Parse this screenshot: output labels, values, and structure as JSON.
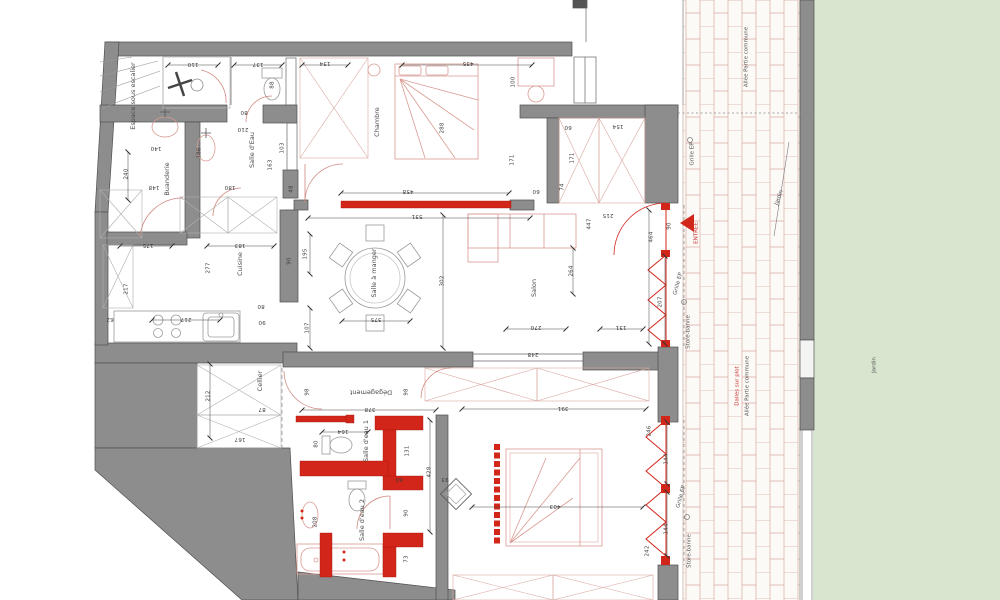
{
  "title": "Plan d'appartement",
  "colors": {
    "wall": "#8d8d8d",
    "wall_edge": "#4f4f4f",
    "new_wall_red": "#d3261a",
    "furniture_line": "#d99a92",
    "garden_green": "#d8e6cf",
    "paving_joint": "#dcaaa2",
    "dim_text": "#3b3b3b",
    "red_text": "#cc3230"
  },
  "rooms": [
    {
      "t": "Espace sous escalier",
      "x": 133,
      "y": 96,
      "r": -90
    },
    {
      "t": "Salle d'Eau",
      "x": 252,
      "y": 150,
      "r": -90
    },
    {
      "t": "Buanderie",
      "x": 167,
      "y": 179,
      "r": -90
    },
    {
      "t": "Chambre",
      "x": 377,
      "y": 122,
      "r": -90
    },
    {
      "t": "Cuisine",
      "x": 240,
      "y": 264,
      "r": -90
    },
    {
      "t": "Salle à manger",
      "x": 374,
      "y": 273,
      "r": -90
    },
    {
      "t": "Salon",
      "x": 534,
      "y": 288,
      "r": -90
    },
    {
      "t": "Cellier",
      "x": 260,
      "y": 381,
      "r": -90
    },
    {
      "t": "Dégagement",
      "x": 371,
      "y": 392,
      "r": 180
    },
    {
      "t": "Salle d'eau 1",
      "x": 366,
      "y": 441,
      "r": -90
    },
    {
      "t": "Salle d'eau 2",
      "x": 362,
      "y": 520,
      "r": -90
    }
  ],
  "annotations": [
    {
      "t": "ENTREE",
      "x": 697,
      "y": 233,
      "r": -90,
      "c": "red_text"
    },
    {
      "t": "Store-banne",
      "x": 689,
      "y": 332,
      "r": -90
    },
    {
      "t": "Store-banne",
      "x": 690,
      "y": 551,
      "r": -90
    },
    {
      "t": "Grille EP",
      "x": 693,
      "y": 154,
      "r": -90
    },
    {
      "t": "Grille EP",
      "x": 679,
      "y": 284,
      "r": -75
    },
    {
      "t": "Grille EP",
      "x": 682,
      "y": 497,
      "r": -75
    },
    {
      "t": "Allée Partie commune",
      "x": 747,
      "y": 57,
      "r": -90
    },
    {
      "t": "Allée Partie commune",
      "x": 748,
      "y": 386,
      "r": -90
    },
    {
      "t": "Dalles sur plot",
      "x": 738,
      "y": 386,
      "r": -90,
      "c": "red_text"
    },
    {
      "t": "Jardin",
      "x": 875,
      "y": 365,
      "r": -90
    },
    {
      "t": "Jardin",
      "x": 780,
      "y": 198,
      "r": -70
    }
  ],
  "dimensions": [
    {
      "t": "110",
      "x": 193,
      "y": 63,
      "r": 180
    },
    {
      "t": "137",
      "x": 258,
      "y": 63,
      "r": 180
    },
    {
      "t": "134",
      "x": 325,
      "y": 62,
      "r": 180
    },
    {
      "t": "435",
      "x": 468,
      "y": 62,
      "r": 180
    },
    {
      "t": "100",
      "x": 514,
      "y": 82,
      "r": -90
    },
    {
      "t": "88",
      "x": 273,
      "y": 85,
      "r": -90
    },
    {
      "t": "80",
      "x": 244,
      "y": 111,
      "r": 180
    },
    {
      "t": "210",
      "x": 243,
      "y": 128,
      "r": 180
    },
    {
      "t": "140",
      "x": 156,
      "y": 147,
      "r": 180
    },
    {
      "t": "186",
      "x": 200,
      "y": 153,
      "r": -90
    },
    {
      "t": "103",
      "x": 283,
      "y": 148,
      "r": -90
    },
    {
      "t": "163",
      "x": 271,
      "y": 165,
      "r": -90
    },
    {
      "t": "240",
      "x": 127,
      "y": 174,
      "r": -90
    },
    {
      "t": "148",
      "x": 154,
      "y": 186,
      "r": 180
    },
    {
      "t": "180",
      "x": 230,
      "y": 186,
      "r": 180
    },
    {
      "t": "48",
      "x": 292,
      "y": 189,
      "r": -90
    },
    {
      "t": "288",
      "x": 443,
      "y": 128,
      "r": -90
    },
    {
      "t": "458",
      "x": 408,
      "y": 190,
      "r": 180
    },
    {
      "t": "531",
      "x": 417,
      "y": 215,
      "r": 180
    },
    {
      "t": "154",
      "x": 618,
      "y": 125,
      "r": 180
    },
    {
      "t": "60",
      "x": 568,
      "y": 126,
      "r": 180
    },
    {
      "t": "171",
      "x": 513,
      "y": 160,
      "r": -90
    },
    {
      "t": "171",
      "x": 573,
      "y": 158,
      "r": -90
    },
    {
      "t": "74",
      "x": 563,
      "y": 187,
      "r": -90
    },
    {
      "t": "60",
      "x": 536,
      "y": 190,
      "r": 180
    },
    {
      "t": "447",
      "x": 590,
      "y": 224,
      "r": -90
    },
    {
      "t": "215",
      "x": 608,
      "y": 214,
      "r": 180
    },
    {
      "t": "464",
      "x": 652,
      "y": 237,
      "r": -90
    },
    {
      "t": "90",
      "x": 670,
      "y": 226,
      "r": -90
    },
    {
      "t": "207",
      "x": 661,
      "y": 302,
      "r": -90
    },
    {
      "t": "131",
      "x": 621,
      "y": 326,
      "r": 180
    },
    {
      "t": "264",
      "x": 572,
      "y": 271,
      "r": -90
    },
    {
      "t": "270",
      "x": 536,
      "y": 326,
      "r": 180
    },
    {
      "t": "248",
      "x": 533,
      "y": 353,
      "r": 180
    },
    {
      "t": "175",
      "x": 148,
      "y": 244,
      "r": 180
    },
    {
      "t": "183",
      "x": 240,
      "y": 244,
      "r": 180
    },
    {
      "t": "90",
      "x": 290,
      "y": 261,
      "r": -90
    },
    {
      "t": "195",
      "x": 306,
      "y": 254,
      "r": -90
    },
    {
      "t": "277",
      "x": 209,
      "y": 268,
      "r": -90
    },
    {
      "t": "217",
      "x": 127,
      "y": 289,
      "r": -90
    },
    {
      "t": "62",
      "x": 110,
      "y": 318,
      "r": 180
    },
    {
      "t": "217",
      "x": 186,
      "y": 318,
      "r": 180
    },
    {
      "t": "80",
      "x": 261,
      "y": 305,
      "r": 180
    },
    {
      "t": "90",
      "x": 262,
      "y": 321,
      "r": 180
    },
    {
      "t": "107",
      "x": 308,
      "y": 328,
      "r": -90
    },
    {
      "t": "375",
      "x": 376,
      "y": 318,
      "r": 180
    },
    {
      "t": "302",
      "x": 443,
      "y": 281,
      "r": -90
    },
    {
      "t": "212",
      "x": 209,
      "y": 396,
      "r": -90
    },
    {
      "t": "87",
      "x": 262,
      "y": 408,
      "r": 180
    },
    {
      "t": "167",
      "x": 240,
      "y": 438,
      "r": 180
    },
    {
      "t": "378",
      "x": 370,
      "y": 408,
      "r": 180
    },
    {
      "t": "98",
      "x": 308,
      "y": 392,
      "r": -90
    },
    {
      "t": "98",
      "x": 407,
      "y": 392,
      "r": -90
    },
    {
      "t": "164",
      "x": 343,
      "y": 430,
      "r": 180
    },
    {
      "t": "80",
      "x": 317,
      "y": 444,
      "r": -90
    },
    {
      "t": "131",
      "x": 408,
      "y": 451,
      "r": -90
    },
    {
      "t": "60",
      "x": 399,
      "y": 478,
      "r": 180
    },
    {
      "t": "93",
      "x": 445,
      "y": 478,
      "r": 180
    },
    {
      "t": "428",
      "x": 430,
      "y": 472,
      "r": -90
    },
    {
      "t": "208",
      "x": 316,
      "y": 522,
      "r": -90
    },
    {
      "t": "90",
      "x": 407,
      "y": 513,
      "r": -90
    },
    {
      "t": "73",
      "x": 407,
      "y": 559,
      "r": -90
    },
    {
      "t": "391",
      "x": 563,
      "y": 407,
      "r": 180
    },
    {
      "t": "403",
      "x": 555,
      "y": 505,
      "r": 180
    },
    {
      "t": "246",
      "x": 650,
      "y": 431,
      "r": -90
    },
    {
      "t": "144",
      "x": 667,
      "y": 459,
      "r": -90
    },
    {
      "t": "144",
      "x": 667,
      "y": 529,
      "r": -90
    },
    {
      "t": "242",
      "x": 648,
      "y": 551,
      "r": -90
    }
  ]
}
